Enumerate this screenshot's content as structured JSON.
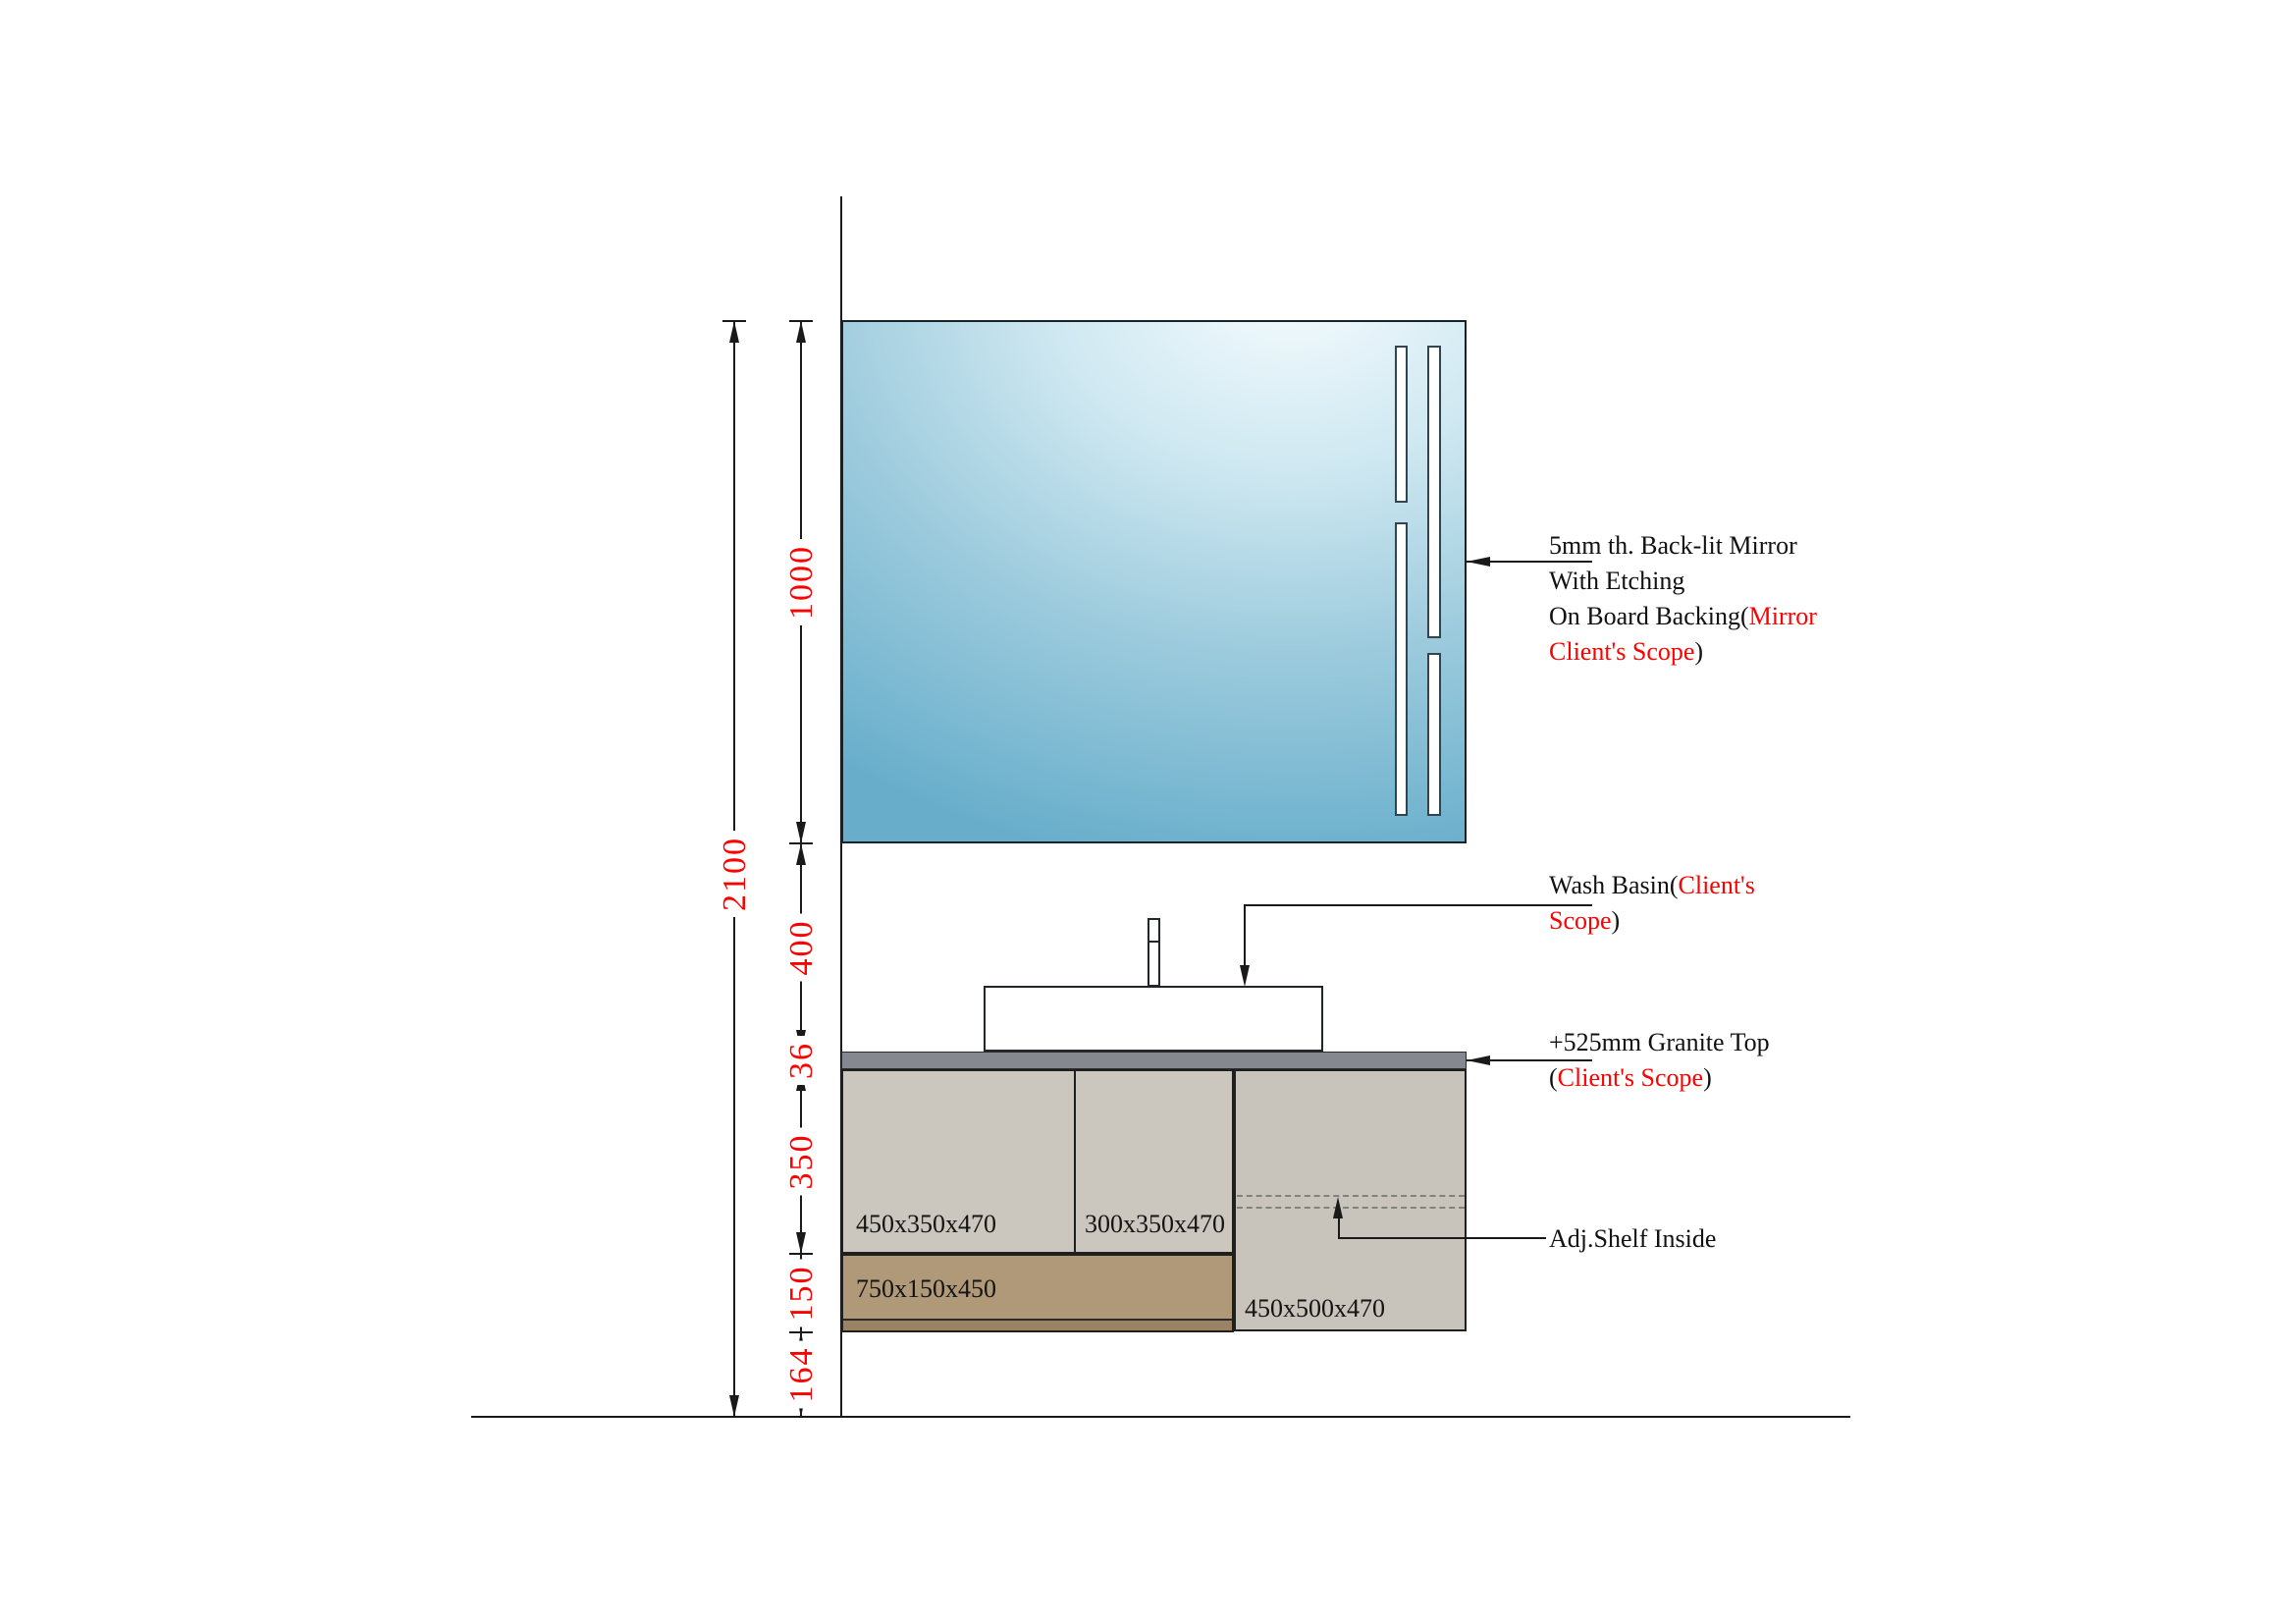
{
  "colors": {
    "red_accent": "#ff0000",
    "mirror_blue": "#68aecb",
    "granite_gray": "#85888f",
    "cabinet_beige": "#cbc6be",
    "drawer_tan": "#b09979",
    "line_black": "#1a1a1a"
  },
  "dimensions": {
    "overall": "2100",
    "mirror_height": "1000",
    "mirror_to_counter": "400",
    "granite_thickness": "36",
    "upper_cabinet_height": "350",
    "drawer_height": "150",
    "floor_clearance": "164"
  },
  "cabinets": {
    "upper_left": "450x350x470",
    "upper_middle": "300x350x470",
    "drawer": "750x150x450",
    "right": "450x500x470"
  },
  "annotations": {
    "mirror": {
      "line1": "5mm th. Back-lit Mirror",
      "line2": "With Etching",
      "line3_black": "On Board Backing(",
      "line3_red": "Mirror",
      "line4_red": "Client's Scope",
      "line4_black": ")"
    },
    "wash_basin": {
      "line1_black": "Wash Basin(",
      "line1_red": "Client's",
      "line2_red": "Scope",
      "line2_black": ")"
    },
    "granite": {
      "line1": "+525mm Granite Top",
      "line2_open": "(",
      "line2_red": "Client's Scope",
      "line2_close": ")"
    },
    "shelf": {
      "label": "Adj.Shelf Inside"
    }
  }
}
